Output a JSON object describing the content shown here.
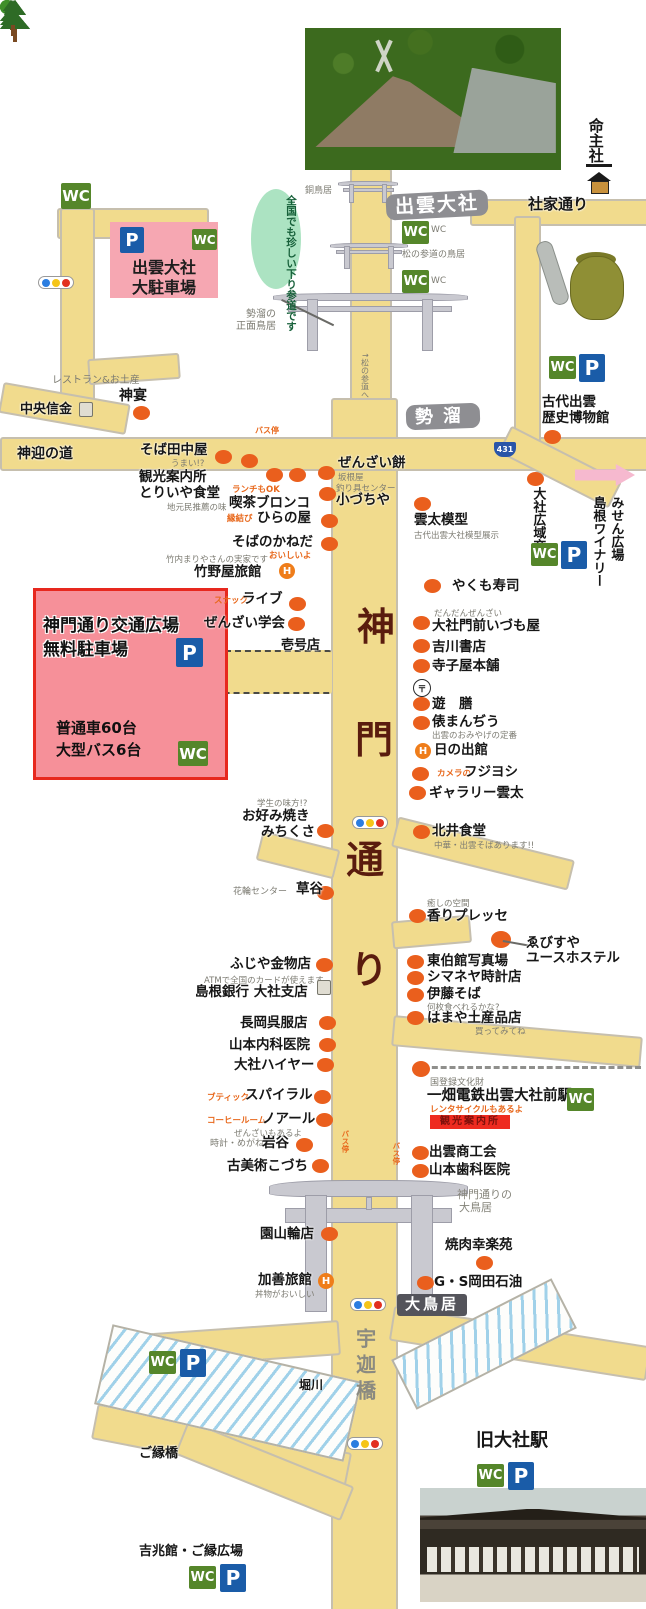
{
  "icons": {
    "wc": "WC",
    "p": "P",
    "route431": "431",
    "hotel": "H",
    "post": "〒"
  },
  "colors": {
    "road": "#f1db8d",
    "dot": "#ea5f1d",
    "wc_green": "#55862a",
    "p_blue": "#1a5ca8",
    "pink_box_top": "#f6a7b2",
    "pink_box_main": "#f69099",
    "red_border": "#e7281e",
    "street_name": "#5a1c0e",
    "gray_label": "#8e8e92",
    "dark_label": "#54545b",
    "green_oval": "#ace3c2",
    "signal": [
      "#2b7de0",
      "#f5c518",
      "#e23020"
    ]
  },
  "boxes": {
    "taisha_lot": {
      "line1": "出雲大社",
      "line2": "大駐車場"
    },
    "kado_lot": {
      "title1": "神門通り交通広場",
      "title2": "無料駐車場",
      "cap1": "普通車60台",
      "cap2": "大型バス6台"
    }
  },
  "labels": [
    {
      "t": "命主社",
      "x": 586,
      "y": 118,
      "k": "S",
      "v": 1,
      "s": 15,
      "n": "label-inochinushi-sha"
    },
    {
      "t": "出雲大社",
      "x": 386,
      "y": 192,
      "k": "GL",
      "r": -3,
      "ls": 2,
      "n": "label-izumo-taisha"
    },
    {
      "t": "社家通り",
      "x": 528,
      "y": 196,
      "k": "S",
      "s": 15,
      "n": "label-shake-dori"
    },
    {
      "t": "銅鳥居",
      "x": 305,
      "y": 186,
      "k": "G10",
      "s": 9
    },
    {
      "t": "全国でも珍しい下り参道です",
      "x": 251,
      "y": 189,
      "k": "OV",
      "v": 1,
      "n": "kudari-sando-note"
    },
    {
      "t": "WC",
      "x": 431,
      "y": 225,
      "k": "NG",
      "s": 9
    },
    {
      "t": "WC",
      "x": 431,
      "y": 276,
      "k": "NG",
      "s": 9
    },
    {
      "t": "松の参道の鳥居",
      "x": 402,
      "y": 250,
      "k": "G10",
      "s": 9
    },
    {
      "t": "勢溜の",
      "x": 246,
      "y": 309,
      "k": "G10"
    },
    {
      "t": "正面鳥居",
      "x": 236,
      "y": 321,
      "k": "G10"
    },
    {
      "t": "↑松の参道へ",
      "x": 360,
      "y": 352,
      "k": "NG",
      "v": 1,
      "s": 8
    },
    {
      "t": "レストラン&お土産",
      "x": 52,
      "y": 375,
      "k": "G10"
    },
    {
      "t": "神宴",
      "x": 119,
      "y": 388,
      "k": "S",
      "s": 14
    },
    {
      "t": "中央信金",
      "x": 20,
      "y": 402,
      "k": "S",
      "s": 13
    },
    {
      "t": "バス停",
      "x": 255,
      "y": 426,
      "k": "NO",
      "s": 8
    },
    {
      "t": "神迎の道",
      "x": 17,
      "y": 446,
      "k": "S",
      "s": 14,
      "n": "label-kamimukae-no-michi"
    },
    {
      "t": "そば田中屋",
      "x": 140,
      "y": 443,
      "k": "S"
    },
    {
      "t": "うまい!?",
      "x": 171,
      "y": 459,
      "k": "NG"
    },
    {
      "t": "観光案内所",
      "x": 139,
      "y": 470,
      "k": "S"
    },
    {
      "t": "とりいや食堂",
      "x": 139,
      "y": 486,
      "k": "S"
    },
    {
      "t": "地元民推薦の味",
      "x": 167,
      "y": 503,
      "k": "NG"
    },
    {
      "t": "ランチもOK",
      "x": 232,
      "y": 485,
      "k": "NO"
    },
    {
      "t": "喫茶ブロンコ",
      "x": 229,
      "y": 496,
      "k": "S"
    },
    {
      "t": "縁結び",
      "x": 227,
      "y": 514,
      "k": "NO"
    },
    {
      "t": "ひらの屋",
      "x": 257,
      "y": 511,
      "k": "S"
    },
    {
      "t": "ぜんざい餅",
      "x": 338,
      "y": 456,
      "k": "S"
    },
    {
      "t": "坂根屋",
      "x": 338,
      "y": 473,
      "k": "NG"
    },
    {
      "t": "釣り具センター",
      "x": 336,
      "y": 484,
      "k": "NG"
    },
    {
      "t": "小づちや",
      "x": 336,
      "y": 493,
      "k": "S"
    },
    {
      "t": "そばのかねだ",
      "x": 232,
      "y": 535,
      "k": "S"
    },
    {
      "t": "おいしいよ",
      "x": 269,
      "y": 551,
      "k": "NO"
    },
    {
      "t": "竹内まりやさんの実家です",
      "x": 166,
      "y": 555,
      "k": "NG"
    },
    {
      "t": "竹野屋旅館",
      "x": 194,
      "y": 565,
      "k": "S"
    },
    {
      "t": "勢溜",
      "x": 406,
      "y": 404,
      "k": "GL",
      "s": 18,
      "ls": 10,
      "r": -2,
      "n": "label-seidamari"
    },
    {
      "t": "雲太模型",
      "x": 414,
      "y": 513,
      "k": "S"
    },
    {
      "t": "古代出雲大社模型展示",
      "x": 414,
      "y": 531,
      "k": "NG"
    },
    {
      "t": "古代出雲",
      "x": 542,
      "y": 395,
      "k": "S"
    },
    {
      "t": "歴史博物館",
      "x": 542,
      "y": 411,
      "k": "S"
    },
    {
      "t": "大社広域交番",
      "x": 530,
      "y": 487,
      "k": "S",
      "v": 1,
      "s": 13
    },
    {
      "t": "島根ワイナリー",
      "x": 590,
      "y": 496,
      "k": "S",
      "v": 1,
      "s": 13
    },
    {
      "t": "みせん広場",
      "x": 608,
      "y": 496,
      "k": "S",
      "v": 1,
      "s": 13
    },
    {
      "t": "やくも寿司",
      "x": 452,
      "y": 579,
      "k": "S"
    },
    {
      "t": "スナック",
      "x": 214,
      "y": 596,
      "k": "NO"
    },
    {
      "t": "ライブ",
      "x": 242,
      "y": 592,
      "k": "S"
    },
    {
      "t": "ぜんざい学会",
      "x": 204,
      "y": 616,
      "k": "S"
    },
    {
      "t": "壱号店",
      "x": 281,
      "y": 638,
      "k": "S",
      "s": 13
    },
    {
      "t": "だんだんぜんざい",
      "x": 434,
      "y": 609,
      "k": "NG"
    },
    {
      "t": "大社門前いづも屋",
      "x": 432,
      "y": 619,
      "k": "S"
    },
    {
      "t": "吉川書店",
      "x": 432,
      "y": 640,
      "k": "S"
    },
    {
      "t": "寺子屋本舗",
      "x": 432,
      "y": 659,
      "k": "S"
    },
    {
      "t": "遊　膳",
      "x": 432,
      "y": 697,
      "k": "S"
    },
    {
      "t": "俵まんぢう",
      "x": 432,
      "y": 715,
      "k": "S"
    },
    {
      "t": "出雲のおみやげの定番",
      "x": 432,
      "y": 731,
      "k": "NG"
    },
    {
      "t": "日の出館",
      "x": 434,
      "y": 743,
      "k": "S"
    },
    {
      "t": "カメラの",
      "x": 437,
      "y": 769,
      "k": "NO"
    },
    {
      "t": "フジヨシ",
      "x": 464,
      "y": 765,
      "k": "S"
    },
    {
      "t": "ギャラリー雲太",
      "x": 429,
      "y": 786,
      "k": "S"
    },
    {
      "t": "学生の味方!?",
      "x": 257,
      "y": 799,
      "k": "NG"
    },
    {
      "t": "お好み焼き",
      "x": 242,
      "y": 809,
      "k": "S"
    },
    {
      "t": "みちくさ",
      "x": 261,
      "y": 825,
      "k": "S"
    },
    {
      "t": "北井食堂",
      "x": 432,
      "y": 824,
      "k": "S"
    },
    {
      "t": "中華・出雲そばあります!!",
      "x": 434,
      "y": 841,
      "k": "NG"
    },
    {
      "t": "花輪センター",
      "x": 233,
      "y": 887,
      "k": "NG",
      "s": 9
    },
    {
      "t": "草谷",
      "x": 296,
      "y": 882,
      "k": "S"
    },
    {
      "t": "癒しの空間",
      "x": 427,
      "y": 899,
      "k": "NG"
    },
    {
      "t": "香りプレッセ",
      "x": 427,
      "y": 909,
      "k": "S"
    },
    {
      "t": "ゑびすや",
      "x": 526,
      "y": 936,
      "k": "S"
    },
    {
      "t": "ユースホステル",
      "x": 526,
      "y": 951,
      "k": "S"
    },
    {
      "t": "ふじや金物店",
      "x": 230,
      "y": 957,
      "k": "S"
    },
    {
      "t": "ATMで全国のカードが使えます",
      "x": 204,
      "y": 976,
      "k": "NG"
    },
    {
      "t": "島根銀行 大社支店",
      "x": 195,
      "y": 985,
      "k": "S"
    },
    {
      "t": "東伯館写真場",
      "x": 427,
      "y": 954,
      "k": "S"
    },
    {
      "t": "シマネヤ時計店",
      "x": 427,
      "y": 970,
      "k": "S"
    },
    {
      "t": "伊藤そば",
      "x": 427,
      "y": 987,
      "k": "S"
    },
    {
      "t": "何枚食べれるかな?",
      "x": 427,
      "y": 1003,
      "k": "NG"
    },
    {
      "t": "はまや土産品店",
      "x": 427,
      "y": 1011,
      "k": "S"
    },
    {
      "t": "買ってみてね",
      "x": 475,
      "y": 1027,
      "k": "NG"
    },
    {
      "t": "長岡呉服店",
      "x": 240,
      "y": 1016,
      "k": "S"
    },
    {
      "t": "山本内科医院",
      "x": 229,
      "y": 1038,
      "k": "S"
    },
    {
      "t": "大社ハイヤー",
      "x": 234,
      "y": 1058,
      "k": "S"
    },
    {
      "t": "ブティック",
      "x": 207,
      "y": 1093,
      "k": "NO"
    },
    {
      "t": "スパイラル",
      "x": 245,
      "y": 1088,
      "k": "S"
    },
    {
      "t": "コーヒールーム",
      "x": 207,
      "y": 1116,
      "k": "NO"
    },
    {
      "t": "ノアール",
      "x": 262,
      "y": 1112,
      "k": "S"
    },
    {
      "t": "ぜんざいもあるよ",
      "x": 234,
      "y": 1129,
      "k": "NG"
    },
    {
      "t": "時計・めがね",
      "x": 210,
      "y": 1139,
      "k": "NG",
      "s": 9
    },
    {
      "t": "岩谷",
      "x": 262,
      "y": 1136,
      "k": "S"
    },
    {
      "t": "古美術こづち",
      "x": 227,
      "y": 1159,
      "k": "S"
    },
    {
      "t": "国登録文化財",
      "x": 430,
      "y": 1078,
      "k": "NG",
      "s": 9
    },
    {
      "t": "一畑電鉄出雲大社前駅",
      "x": 427,
      "y": 1088,
      "k": "S",
      "s": 14.5,
      "n": "label-ichibata-station"
    },
    {
      "t": "レンタサイクルもあるよ",
      "x": 430,
      "y": 1105,
      "k": "NO"
    },
    {
      "t": "観光案内所",
      "x": 430,
      "y": 1115,
      "k": "BD",
      "n": "info-center-badge"
    },
    {
      "t": "バス停",
      "x": 340,
      "y": 1130,
      "k": "NO",
      "v": 1,
      "s": 7.5
    },
    {
      "t": "バス停",
      "x": 391,
      "y": 1142,
      "k": "NO",
      "v": 1,
      "s": 7.5
    },
    {
      "t": "出雲商工会",
      "x": 429,
      "y": 1145,
      "k": "S"
    },
    {
      "t": "山本歯科医院",
      "x": 429,
      "y": 1163,
      "k": "S"
    },
    {
      "t": "神門通りの",
      "x": 457,
      "y": 1189,
      "k": "G11"
    },
    {
      "t": "大鳥居",
      "x": 459,
      "y": 1202,
      "k": "G11"
    },
    {
      "t": "園山輪店",
      "x": 260,
      "y": 1227,
      "k": "S"
    },
    {
      "t": "焼肉幸楽苑",
      "x": 445,
      "y": 1238,
      "k": "S"
    },
    {
      "t": "加善旅館",
      "x": 258,
      "y": 1273,
      "k": "S"
    },
    {
      "t": "丼物がおいしい",
      "x": 255,
      "y": 1290,
      "k": "NG"
    },
    {
      "t": "G・S岡田石油",
      "x": 434,
      "y": 1275,
      "k": "S"
    },
    {
      "t": "大鳥居",
      "x": 397,
      "y": 1294,
      "k": "DL",
      "n": "label-otorii"
    },
    {
      "t": "堀川",
      "x": 299,
      "y": 1378,
      "k": "S",
      "s": 12,
      "n": "label-horikawa"
    },
    {
      "t": "宇迦橋",
      "x": 352,
      "y": 1328,
      "k": "UK",
      "v": 1,
      "n": "label-ukabashi"
    },
    {
      "t": "ご縁橋",
      "x": 139,
      "y": 1446,
      "k": "S",
      "s": 13,
      "n": "label-goenbashi"
    },
    {
      "t": "旧大社駅",
      "x": 476,
      "y": 1430,
      "k": "S",
      "s": 18,
      "n": "label-kyu-taisha-station"
    },
    {
      "t": "吉兆館・ご縁広場",
      "x": 139,
      "y": 1544,
      "k": "S",
      "s": 13,
      "n": "label-kicchokan"
    },
    {
      "t": "神",
      "x": 357,
      "y": 605,
      "k": "ST",
      "n": "street-name-char"
    },
    {
      "t": "門",
      "x": 355,
      "y": 718,
      "k": "ST",
      "n": "street-name-char"
    },
    {
      "t": "通",
      "x": 346,
      "y": 838,
      "k": "ST",
      "n": "street-name-char"
    },
    {
      "t": "り",
      "x": 350,
      "y": 948,
      "k": "ST",
      "n": "street-name-char"
    }
  ],
  "roads": [
    [
      350,
      168,
      38,
      262,
      0,
      0
    ],
    [
      331,
      398,
      63,
      1211,
      0,
      0
    ],
    [
      0,
      437,
      646,
      30,
      0,
      0
    ],
    [
      470,
      199,
      176,
      23,
      0,
      0
    ],
    [
      514,
      216,
      23,
      225,
      0,
      0
    ],
    [
      498,
      452,
      120,
      26,
      27,
      0
    ],
    [
      57,
      208,
      148,
      27,
      0,
      0
    ],
    [
      60,
      208,
      31,
      202,
      0,
      0
    ],
    [
      0,
      393,
      125,
      27,
      10,
      0
    ],
    [
      88,
      356,
      88,
      22,
      -4,
      0
    ],
    [
      222,
      650,
      110,
      40,
      0,
      1
    ],
    [
      258,
      840,
      76,
      26,
      14,
      0
    ],
    [
      392,
      838,
      178,
      27,
      14,
      0
    ],
    [
      392,
      918,
      75,
      24,
      -5,
      0
    ],
    [
      392,
      1026,
      246,
      27,
      5,
      0
    ],
    [
      112,
      1328,
      224,
      31,
      -4,
      0
    ],
    [
      92,
      1428,
      255,
      32,
      11,
      0
    ],
    [
      390,
      1326,
      256,
      31,
      9,
      0
    ],
    [
      175,
      1452,
      175,
      33,
      22,
      0
    ]
  ],
  "rivers": [
    [
      100,
      1352,
      252,
      78,
      13
    ],
    [
      394,
      1316,
      176,
      52,
      -27
    ]
  ],
  "railway": [
    423,
    1066,
    218
  ],
  "toriis": [
    [
      341,
      181,
      54,
      22,
      5
    ],
    [
      334,
      243,
      70,
      26,
      6
    ],
    [
      283,
      293,
      174,
      58,
      11
    ],
    [
      280,
      1180,
      178,
      132,
      22
    ]
  ],
  "dots": [
    [
      133,
      406
    ],
    [
      215,
      450
    ],
    [
      241,
      454
    ],
    [
      266,
      468
    ],
    [
      289,
      468
    ],
    [
      318,
      466
    ],
    [
      319,
      487
    ],
    [
      321,
      514
    ],
    [
      321,
      537
    ],
    [
      414,
      497
    ],
    [
      544,
      430
    ],
    [
      527,
      472
    ],
    [
      424,
      579
    ],
    [
      289,
      597
    ],
    [
      288,
      617
    ],
    [
      413,
      616
    ],
    [
      413,
      639
    ],
    [
      413,
      659
    ],
    [
      413,
      697
    ],
    [
      413,
      716
    ],
    [
      412,
      767
    ],
    [
      409,
      786
    ],
    [
      317,
      824
    ],
    [
      413,
      825
    ],
    [
      317,
      886
    ],
    [
      409,
      909
    ],
    [
      491,
      931,
      20,
      17
    ],
    [
      407,
      955
    ],
    [
      407,
      971
    ],
    [
      407,
      988
    ],
    [
      407,
      1011
    ],
    [
      316,
      958
    ],
    [
      319,
      1016
    ],
    [
      319,
      1038
    ],
    [
      317,
      1058
    ],
    [
      314,
      1090
    ],
    [
      316,
      1113
    ],
    [
      296,
      1138
    ],
    [
      312,
      1159
    ],
    [
      412,
      1061,
      18,
      16
    ],
    [
      412,
      1146
    ],
    [
      412,
      1164
    ],
    [
      321,
      1227
    ],
    [
      476,
      1256
    ],
    [
      417,
      1276
    ]
  ],
  "wc_icons": [
    [
      61,
      183,
      30,
      26
    ],
    [
      402,
      221
    ],
    [
      402,
      270
    ],
    [
      549,
      356
    ],
    [
      531,
      543
    ],
    [
      567,
      1088
    ],
    [
      149,
      1351
    ],
    [
      477,
      1464
    ],
    [
      189,
      1566
    ]
  ],
  "p_icons": [
    [
      579,
      354
    ],
    [
      561,
      541
    ],
    [
      180,
      1349
    ],
    [
      508,
      1462
    ],
    [
      220,
      1564
    ]
  ],
  "hotel_icons": [
    [
      279,
      563
    ],
    [
      415,
      743
    ],
    [
      318,
      1273
    ]
  ],
  "post_icons": [
    [
      413,
      679
    ]
  ],
  "bank_icons": [
    [
      79,
      402
    ],
    [
      317,
      980
    ]
  ],
  "traffic_lights": [
    [
      38,
      276
    ],
    [
      352,
      816
    ],
    [
      350,
      1298
    ],
    [
      347,
      1437
    ]
  ],
  "trees": [
    [
      242,
      404
    ],
    [
      337,
      1101
    ],
    [
      387,
      1115
    ],
    [
      320,
      1562
    ]
  ],
  "pines": [
    [
      296,
      203,
      1
    ],
    [
      287,
      243,
      1
    ],
    [
      298,
      281,
      1
    ],
    [
      397,
      205,
      1
    ],
    [
      403,
      245,
      1
    ],
    [
      395,
      283,
      1
    ],
    [
      281,
      328,
      1.4
    ],
    [
      295,
      366,
      1.4
    ],
    [
      268,
      398,
      1.4
    ],
    [
      423,
      328,
      1.4
    ],
    [
      437,
      364,
      1.4
    ],
    [
      427,
      398,
      1.4
    ],
    [
      443,
      352,
      1.2
    ]
  ],
  "lines": [
    [
      282,
      299,
      58,
      26
    ],
    [
      503,
      940,
      26,
      10
    ]
  ]
}
